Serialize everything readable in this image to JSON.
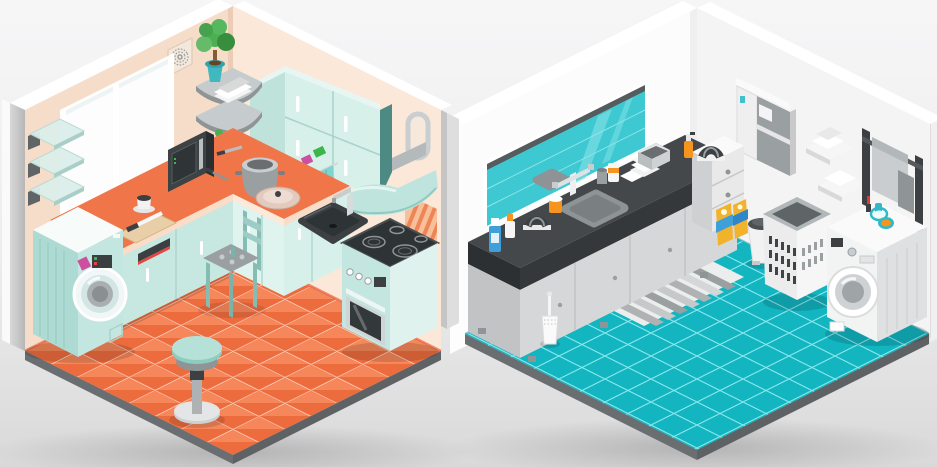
{
  "scene": {
    "title": "Isometric interiors illustration: kitchen room and laundry bathroom room",
    "rooms": [
      {
        "id": "kitchen",
        "label": "Kitchen",
        "objects": [
          "window",
          "glass-wall-shelves",
          "air-vent",
          "corner-shelves",
          "potted-plant",
          "towel-stack",
          "storage-box",
          "upper-cabinets",
          "fridge-magnets",
          "range-hood",
          "vent-duct",
          "wall-arch-fixture",
          "backsplash",
          "orange-tile-panel",
          "counter",
          "base-cabinets",
          "sink",
          "faucet",
          "cooking-pot",
          "pan-lid",
          "microwave",
          "spatula",
          "knife",
          "cutting-board",
          "coffee-cup",
          "hanging-towel",
          "stove-oven",
          "washing-machine",
          "chair",
          "bar-stool",
          "orange-diamond-tile-floor"
        ]
      },
      {
        "id": "laundry-bathroom",
        "label": "Laundry / bathroom",
        "objects": [
          "mirror-strip",
          "wall-cabinet",
          "wall-shelves-towels",
          "towel-rack",
          "hanging-towel",
          "vanity-counter",
          "vanity-cabinets",
          "sink-large",
          "sink-small",
          "faucet",
          "soap-bottles",
          "orange-jar",
          "hair-dryer",
          "towel-pile",
          "storage-basket-box",
          "drawer-unit",
          "spray-bottle",
          "toilet-brush",
          "striped-bath-mat",
          "detergent-boxes",
          "pedal-bin",
          "laundry-basket",
          "washing-machine",
          "lipstick",
          "compact-mirror",
          "teal-square-tile-floor"
        ]
      }
    ]
  },
  "palette": {
    "bg_top": "#f6f6f7",
    "bg_bottom": "#d9d9da",
    "kitchen_wall_left": "#f6ddc9",
    "kitchen_wall_right": "#fbe8d8",
    "kitchen_floor_light": "#f5875a",
    "kitchen_floor_dark": "#ed6c3e",
    "counter_orange": "#f0764a",
    "cabinet_mint": "#c7e8e1",
    "cabinet_mint_light": "#d8f0ea",
    "appliance_mint": "#c4e6e1",
    "hood_mint": "#bfe4de",
    "deep_teal_panel": "#4e8a84",
    "bath_floor_teal": "#12b5c0",
    "mirror_teal": "#3ec9d2",
    "bath_counter_dark": "#44484a",
    "bath_cabinet_gray": "#d6d7d8",
    "rim_gray": "#6a6e70",
    "metal_gray": "#9aa0a2",
    "dark_gray": "#3c4043",
    "accent_orange": "#f5941e",
    "accent_blue": "#3f9fd8",
    "accent_yellow": "#f2b32c",
    "accent_magenta": "#cd4fa0",
    "accent_green": "#3cb54a",
    "accent_red": "#d93a3a",
    "towel_teal": "#7fd4cf",
    "white": "#ffffff"
  }
}
